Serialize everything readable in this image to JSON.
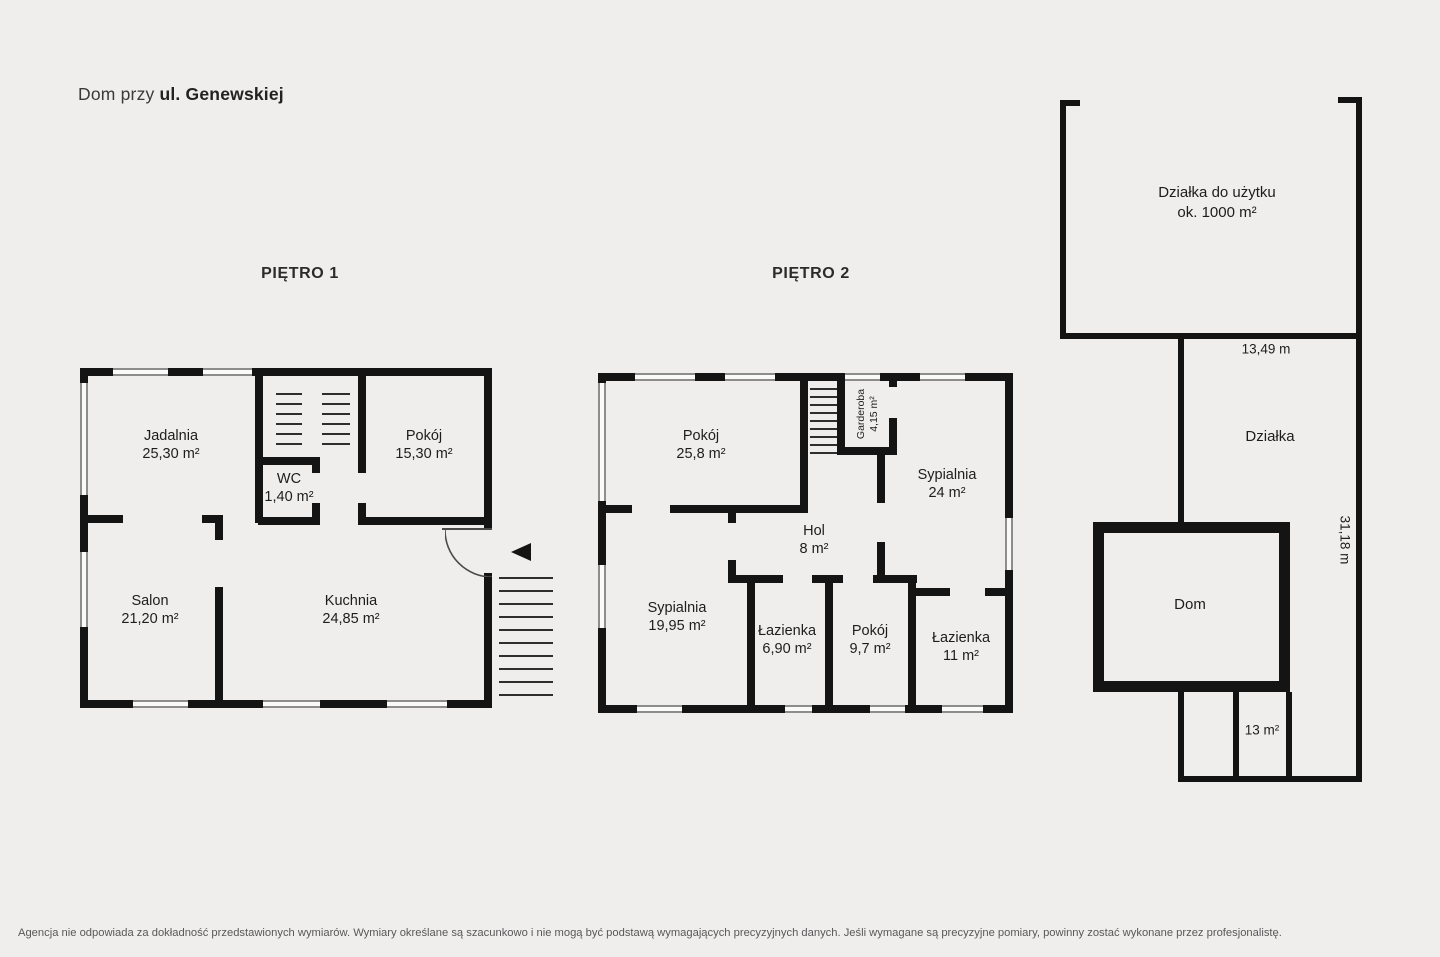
{
  "title": {
    "prefix": "Dom przy",
    "street": "ul. Genewskiej"
  },
  "floors": [
    {
      "label": "PIĘTRO 1",
      "rooms": [
        {
          "name": "Jadalnia",
          "area": "25,30 m²"
        },
        {
          "name": "Pokój",
          "area": "15,30 m²"
        },
        {
          "name": "WC",
          "area": "1,40 m²"
        },
        {
          "name": "Salon",
          "area": "21,20 m²"
        },
        {
          "name": "Kuchnia",
          "area": "24,85 m²"
        }
      ]
    },
    {
      "label": "PIĘTRO 2",
      "rooms": [
        {
          "name": "Pokój",
          "area": "25,8 m²"
        },
        {
          "name": "Garderoba",
          "area": "4,15 m²"
        },
        {
          "name": "Sypialnia",
          "area": "24 m²"
        },
        {
          "name": "Hol",
          "area": "8 m²"
        },
        {
          "name": "Sypialnia",
          "area": "19,95 m²"
        },
        {
          "name": "Łazienka",
          "area": "6,90 m²"
        },
        {
          "name": "Pokój",
          "area": "9,7 m²"
        },
        {
          "name": "Łazienka",
          "area": "11 m²"
        }
      ]
    }
  ],
  "plot": {
    "usable_label": "Działka do użytku",
    "usable_area": "ok. 1000 m²",
    "width_dimension": "13,49 m",
    "depth_dimension": "31,18 m",
    "parcel_label": "Działka",
    "house_label": "Dom",
    "outbuilding_area": "13 m²"
  },
  "footer": {
    "disclaimer": "Agencja nie odpowiada za dokładność przedstawionych wymiarów. Wymiary określane są szacunkowo i nie mogą być podstawą wymagających precyzyjnych danych. Jeśli wymagane są precyzyjne pomiary, powinny zostać wykonane przez profesjonalistę."
  },
  "colors": {
    "background": "#efeeec",
    "wall": "#141414",
    "window_fill": "#fafaf8",
    "window_frame": "#8d8d8d",
    "text": "#1d1d1d",
    "muted_text": "#58585a"
  }
}
